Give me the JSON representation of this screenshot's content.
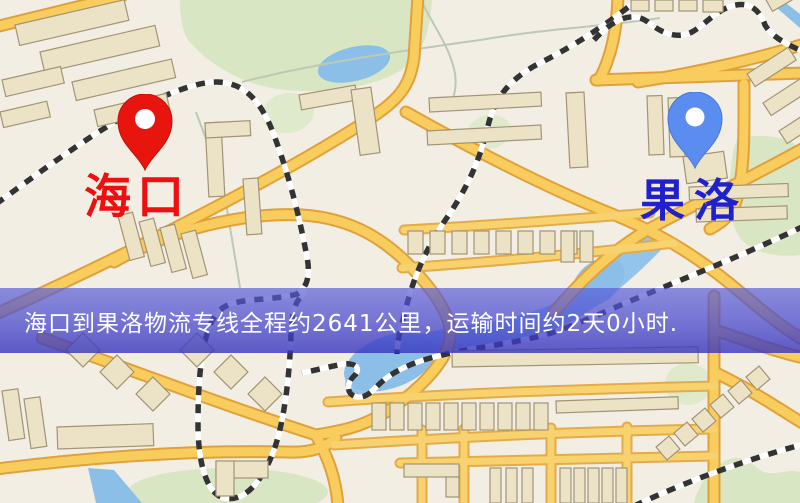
{
  "map": {
    "origin_marker": {
      "label": "海口",
      "pin_color": "#e8150e",
      "pin_hole_color": "#ffffff",
      "label_color": "#ee1010"
    },
    "destination_marker": {
      "label": "果洛",
      "pin_color": "#5b8cf0",
      "pin_hole_color": "#ffffff",
      "label_color": "#2020cc"
    },
    "banner": {
      "text": "海口到果洛物流专线全程约2641公里，运输时间约2天0小时.",
      "route_from": "海口",
      "route_to": "果洛",
      "distance": "约2641公里",
      "duration": "约2天0小时",
      "background_color": "#5153cc",
      "text_color": "#ffffff"
    },
    "palette": {
      "land": "#f2eee4",
      "park": "#d9e6c4",
      "water": "#8cbfe8",
      "road_fill": "#f8cd5d",
      "road_casing": "#e0a13c",
      "building": "#ece3c6",
      "building_outline": "#a29476",
      "railway": "#333333"
    }
  }
}
